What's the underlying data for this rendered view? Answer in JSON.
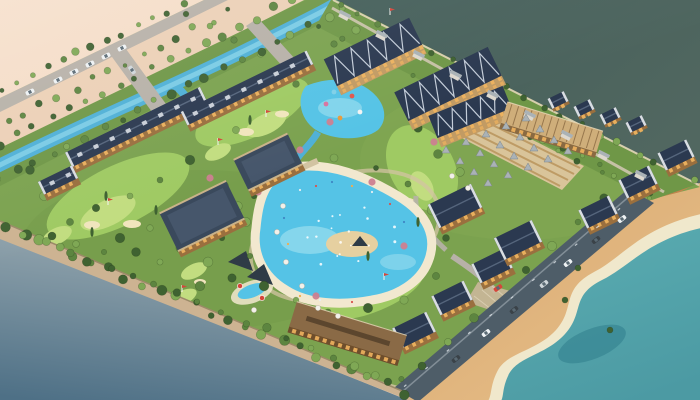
{
  "meta": {
    "title": "Aerial 3D render — lakeside golf and waterpark resort master plan",
    "type": "architectural-visualization",
    "view": "high-angle oblique aerial perspective, miniature-model style"
  },
  "palette": {
    "outer_peach": "#f6e0cc",
    "outer_peach_deep": "#eccdb2",
    "inner_peach": "#ecd0b6",
    "grey_water_light": "#96a7af",
    "grey_water_dark": "#4e7086",
    "lake_dark": "#435e59",
    "lake_light": "#516760",
    "sea_teal": "#5aacb1",
    "sea_teal_deep": "#4c9aa3",
    "sea_deep": "#2f7e8c",
    "shore_cream": "#f0e8cc",
    "sand_beach": "#d9a76f",
    "sand_light": "#e7c18b",
    "buffer_green": "#6f9747",
    "lawn": "#7ba24f",
    "fairway": "#9fca63",
    "putting_green": "#c2dd80",
    "bunker_sand": "#f1e5bd",
    "canal_blue": "#4fb0d6",
    "canal_light": "#85d2e8",
    "pool_blue": "#55c3e6",
    "pool_light": "#a5e2f0",
    "pool_rim": "#f2e8cf",
    "island_sand": "#e6d0a0",
    "road_light": "#b7b1a8",
    "road_dark": "#4e5d68",
    "path_tan": "#d2c3a2",
    "plaza_paving": "#cbb79a",
    "edge_bevel": "#cdb392",
    "bevel_line": "#9b8a68",
    "terracotta": "#c8824d",
    "tree_dark": "#3f6231",
    "tree_mid": "#5d8540",
    "tree_light": "#7fa855",
    "blossom_pink": "#cc8090",
    "roof_navy": "#2b3950",
    "roof_navy_light": "#3a495c",
    "roof_grey": "#aab2b6",
    "roof_tan": "#cfae7a",
    "roof_brown": "#8a6a46",
    "wall_wood": "#9a6f3e",
    "wall_dark": "#6e4e2c",
    "wall_tan": "#c29b63",
    "window_glow": "#f0b45f",
    "cottage_white": "#ddd8ce",
    "pavilion_dark": "#2f3b46",
    "cabana_deck": "#d9c49a",
    "cabana_stripe": "#b79258",
    "car_white": "#eef2f4",
    "car_silver": "#cfd6da",
    "car_dark": "#3a4248",
    "flag_red": "#d6453a",
    "umbrella_white": "#f2f0ea"
  },
  "scene": {
    "regions": [
      {
        "name": "vacant-land",
        "position": "top-left",
        "description": "pale peach graded development land with a tree-lined boulevard, cross street and parked cars"
      },
      {
        "name": "lake",
        "position": "top-right",
        "description": "deep teal open water beyond a green coastal strip of cottages and trees"
      },
      {
        "name": "harbor-water",
        "position": "bottom-left",
        "description": "smooth grey-blue water along the bevelled model edge"
      },
      {
        "name": "beach",
        "position": "bottom-right",
        "description": "golden sand beach, pale surf line and turquoise sea beside a coastal road with traffic"
      },
      {
        "name": "resort-site",
        "position": "center-diagonal",
        "description": "wooded resort parcel with hotel complex, timber condo rows, gabled lodges, golf holes, canals, lagoon pool and waterpark"
      }
    ],
    "features": [
      {
        "name": "main-hotel",
        "description": "large timber hotel complex with sawtooth navy roofs at top center"
      },
      {
        "name": "waterpark-pool",
        "description": "bright blue pool with colorful slides beside the hotel"
      },
      {
        "name": "lagoon-pool",
        "description": "central turquoise swimming lagoon with sandy rim and palm island"
      },
      {
        "name": "splash-pool",
        "description": "small pool with red and white umbrellas near the lower edge"
      },
      {
        "name": "shade-pavilions",
        "description": "dark tensile canopy pavilions by the splash pool"
      },
      {
        "name": "condo-rows",
        "description": "long timber condominium rows with dark gabled roofs on the left"
      },
      {
        "name": "gabled-lodges",
        "description": "rows of steep-roofed lodges stepping along the coastal road"
      },
      {
        "name": "cabana-court",
        "description": "grid of sun loungers and a long ribbed-roof cabana barn"
      },
      {
        "name": "garden-tents",
        "description": "rows of grey pyramid garden canopies"
      },
      {
        "name": "clubhouse",
        "description": "long low restaurant/clubhouse building near the waterfront lawn"
      },
      {
        "name": "golf-holes",
        "description": "bright fairways and putting greens with cream bunkers and red pin flags"
      },
      {
        "name": "canal",
        "description": "winding blue canal crossing the upper parcel under small road bridges"
      },
      {
        "name": "coastal-road",
        "description": "dark asphalt shore road with white, silver, dark and one red vehicle"
      },
      {
        "name": "coastal-strip",
        "description": "green strip with small white cottages between resort and lake"
      },
      {
        "name": "perimeter-trees",
        "description": "dense tree rows along roads, canal banks and the waterfront slope"
      }
    ]
  }
}
